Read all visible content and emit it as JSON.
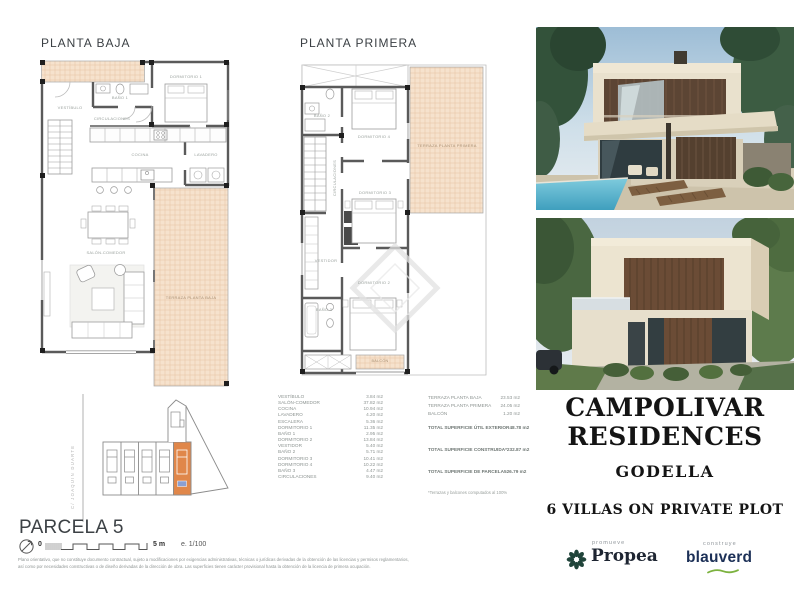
{
  "plans": {
    "baja": {
      "title": "PLANTA BAJA",
      "rooms": {
        "vestibulo": "VESTÍBULO",
        "bano1": "BAÑO 1",
        "circulaciones": "CIRCULACIONES",
        "dormitorio1": "DORMITORIO 1",
        "cocina": "COCINA",
        "lavadero": "LAVADERO",
        "salon_comedor": "SALÓN-COMEDOR",
        "terraza": "TERRAZA PLANTA BAJA"
      }
    },
    "primera": {
      "title": "PLANTA PRIMERA",
      "rooms": {
        "bano2": "BAÑO 2",
        "dormitorio4": "DORMITORIO 4",
        "circulaciones": "CIRCULACIONES",
        "dormitorio3": "DORMITORIO 3",
        "terraza": "TERRAZA PLANTA PRIMERA",
        "vestidor": "VESTIDOR",
        "dormitorio2": "DORMITORIO 2",
        "bano3": "BAÑO 3",
        "balcon": "BALCÓN"
      }
    }
  },
  "surfaces": {
    "interior": [
      {
        "label": "VESTÍBULO",
        "value": "3.84 m2"
      },
      {
        "label": "SALÓN-COMEDOR",
        "value": "37.82 m2"
      },
      {
        "label": "COCINA",
        "value": "10.94 m2"
      },
      {
        "label": "LAVADERO",
        "value": "4.20 m2"
      },
      {
        "label": "ESCALERA",
        "value": "5.36 m2"
      },
      {
        "label": "DORMITORIO 1",
        "value": "11.35 m2"
      },
      {
        "label": "BAÑO 1",
        "value": "2.95 m2"
      },
      {
        "label": "DORMITORIO 2",
        "value": "13.84 m2"
      },
      {
        "label": "VESTIDOR",
        "value": "5.40 m2"
      },
      {
        "label": "BAÑO 2",
        "value": "5.71 m2"
      },
      {
        "label": "DORMITORIO 3",
        "value": "10.41 m2"
      },
      {
        "label": "DORMITORIO 4",
        "value": "10.22 m2"
      },
      {
        "label": "BAÑO 3",
        "value": "4.47 m2"
      },
      {
        "label": "CIRCULACIONES",
        "value": "9.40 m2"
      }
    ],
    "exterior": [
      {
        "label": "TERRAZA PLANTA BAJA",
        "value": "23.53 m2"
      },
      {
        "label": "TERRAZA PLANTA PRIMERA",
        "value": "24.05 m2"
      },
      {
        "label": "BALCÓN",
        "value": "1.20 m2"
      }
    ],
    "totals": [
      {
        "label": "TOTAL SUPERFICIE ÚTIL EXTERIOR",
        "value": "48.78 m2"
      },
      {
        "label": "TOTAL SUPERFICIE CONSTRUIDA*",
        "value": "232.87 m2"
      },
      {
        "label": "TOTAL SUPERFICIE DE PARCELA",
        "value": "526.79 m2"
      }
    ],
    "footnote": "*Terrazas y balcones computados al 100%"
  },
  "site_plan": {
    "street_label": "C/ JOAQUIN DUARTE",
    "highlight_color": "#e0874a",
    "pool_marker_color": "#8b9fd1"
  },
  "parcel": {
    "title": "PARCELA 5",
    "scale_zero": "0",
    "scale_end": "5 m",
    "scale_ratio": "e. 1/100"
  },
  "disclaimer": {
    "line1": "Plano orientativo, que no constituye documento contractual, sujeto a modificaciones por exigencias administrativas, técnicas o jurídicas derivadas de la obtención de las licencias y permisos reglamentarios,",
    "line2": "así como por necesidades constructivas o de diseño derivadas de la dirección de obra. Las superficies tienen carácter provisional hasta la obtención de la licencia de primera ocupación."
  },
  "branding": {
    "title_line1": "CAMPOLIVAR",
    "title_line2": "RESIDENCES",
    "location": "GODELLA",
    "tagline": "6 VILLAS ON PRIVATE PLOT",
    "promoter_label": "promueve",
    "promoter_name": "Propea",
    "promoter_icon_color": "#20443a",
    "builder_label": "construye",
    "builder_name": "blauverd",
    "builder_color": "#1c3057",
    "builder_accent": "#7cb23f",
    "terrace_fill": "#f6e2cd",
    "terrace_grid": "#e6c2a2"
  }
}
